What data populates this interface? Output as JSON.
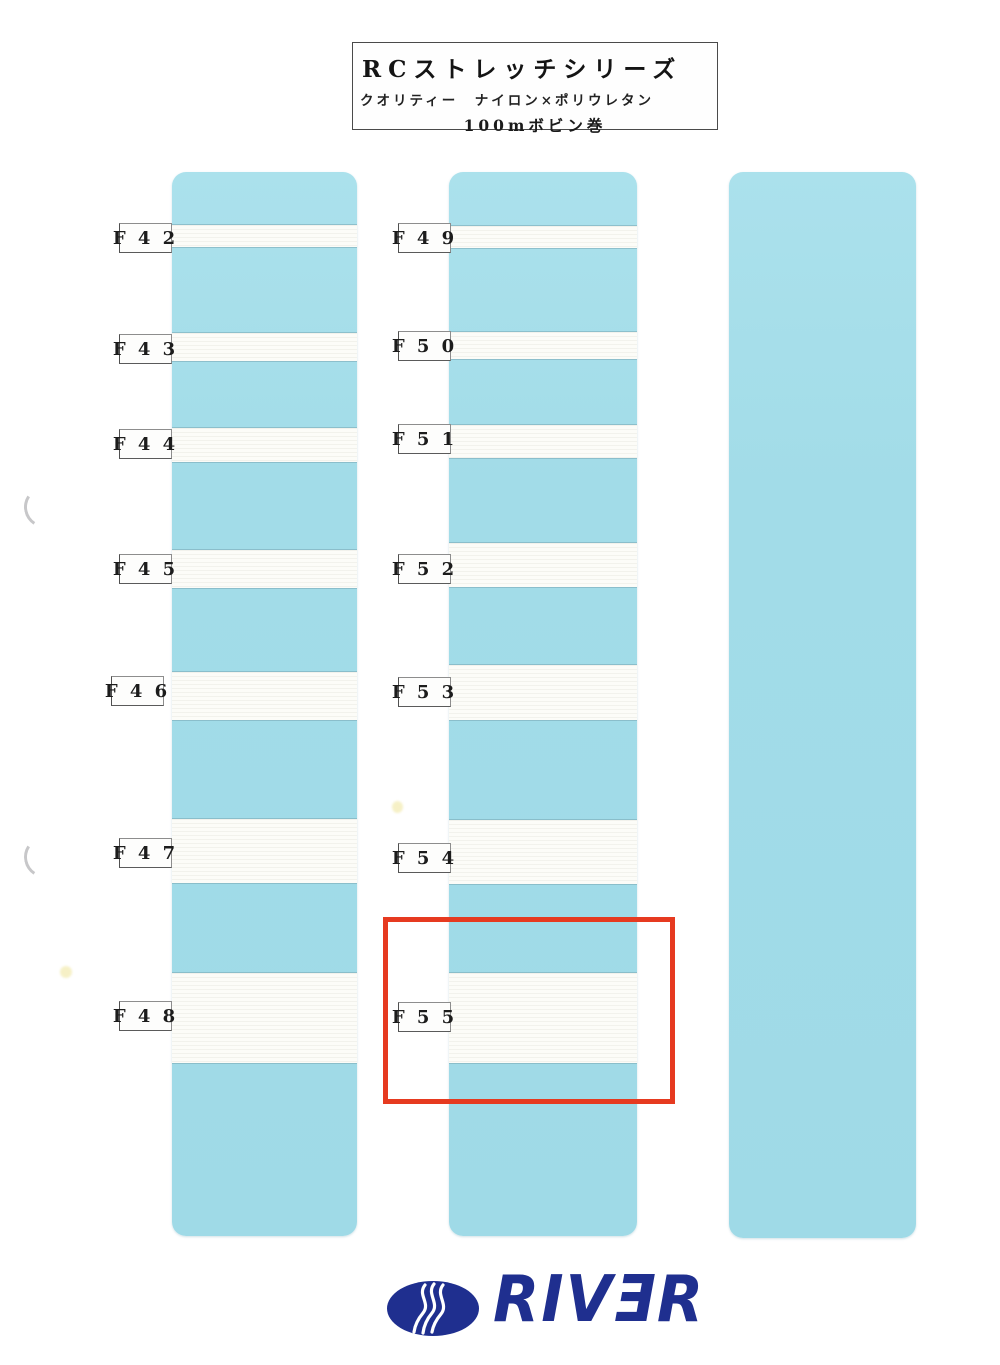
{
  "title_box": {
    "line1": "RCストレッチシリーズ",
    "line2": "クオリティー　ナイロン×ポリウレタン",
    "line3": "100mボビン巻"
  },
  "samples": {
    "left": [
      "F 4 2",
      "F 4 3",
      "F 4 4",
      "F 4 5",
      "F 4 6",
      "F 4 7",
      "F 4 8"
    ],
    "middle": [
      "F 4 9",
      "F 5 0",
      "F 5 1",
      "F 5 2",
      "F 5 3",
      "F 5 4",
      "F 5 5"
    ]
  },
  "highlight": {
    "highlighted_code": "F 5 5"
  },
  "logo": {
    "brand_text": "RIVƎR"
  },
  "colors": {
    "panel_blue": "#a2dce8",
    "strip_white": "#fcfcf8",
    "highlight_red": "#e63a20",
    "logo_navy": "#1f2f8f",
    "label_text": "#1c1c1c"
  }
}
